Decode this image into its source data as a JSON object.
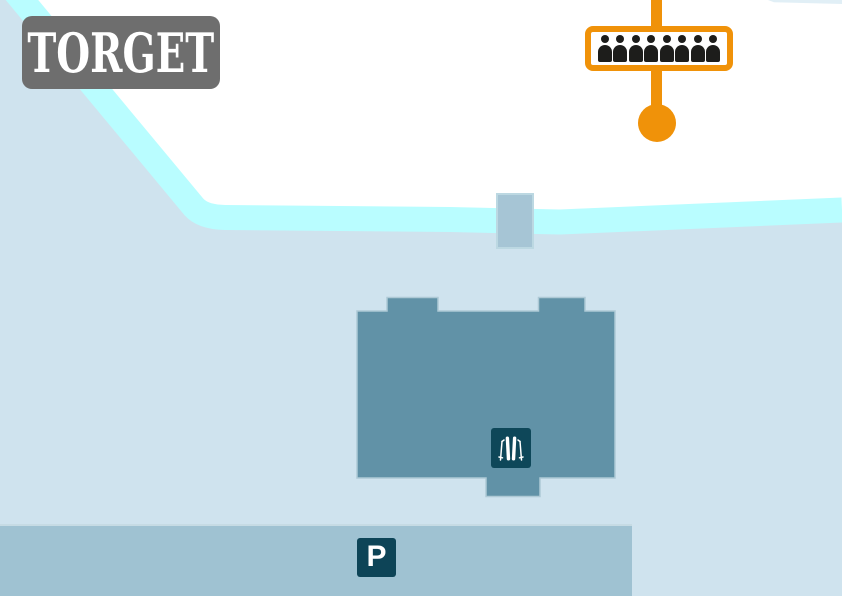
{
  "map": {
    "type": "resort-map-section",
    "colors": {
      "background": "#ffffff",
      "snow_area": "#cfe3ee",
      "river": "#b9fdff",
      "building": "#6192a7",
      "parking_area": "#9fc2d2",
      "bridge": "#a6c5d5",
      "marker_dark": "#0e4759",
      "label_box_gray": "#6e6e6e",
      "lift_orange": "#f09209",
      "queue_people_black": "#1d1d1b"
    }
  },
  "area_label": {
    "text": "TORGET"
  },
  "lift_queue": {
    "icon": "queue-people",
    "people_count": 8
  },
  "lift": {
    "dot": "lift-station-dot",
    "line": "lift-line"
  },
  "parking": {
    "label": "P"
  },
  "ski_rental": {
    "icon": "skis-and-poles"
  }
}
